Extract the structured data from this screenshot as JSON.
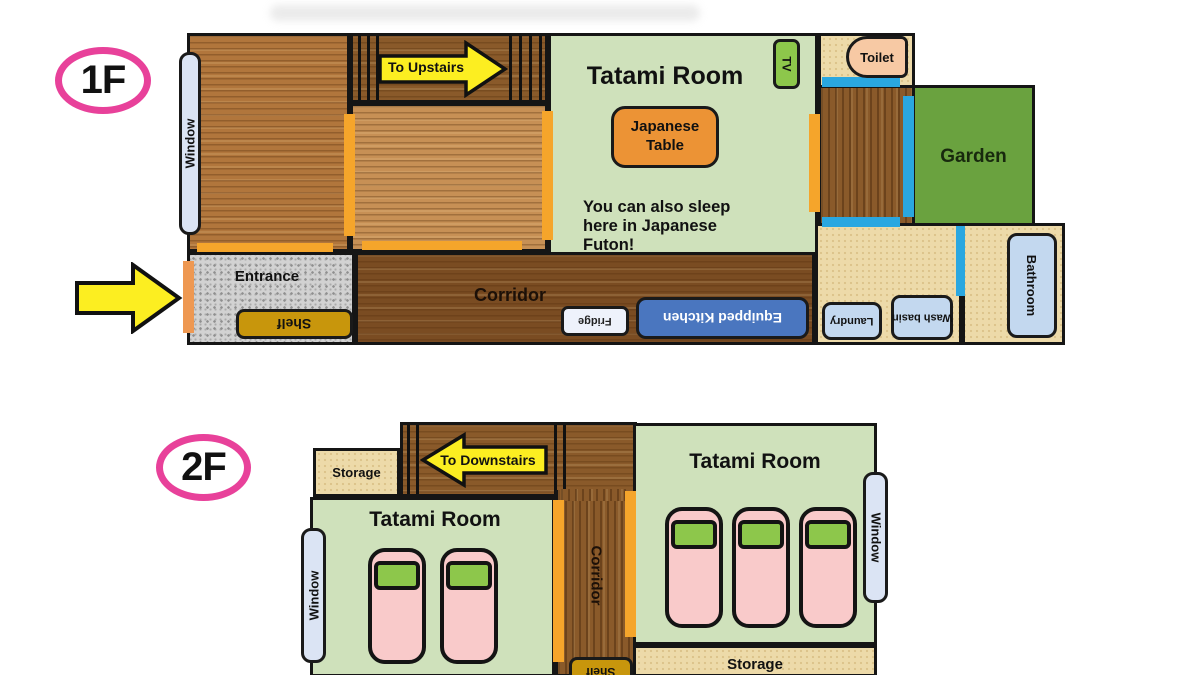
{
  "f1": {
    "badge": "1F",
    "window": "Window",
    "to_upstairs": "To Upstairs",
    "tatami_title": "Tatami Room",
    "tv": "TV",
    "japanese_table": "Japanese\nTable",
    "futon_note": "You can also sleep\nhere in Japanese\nFuton!",
    "toilet": "Toilet",
    "garden": "Garden",
    "entrance": "Entrance",
    "shelf": "Shelf",
    "corridor": "Corridor",
    "fridge": "Fridge",
    "kitchen": "Equipped Kitchen",
    "laundry": "Laundry",
    "wash_basin": "Wash\nbasin",
    "bathroom": "Bathroom"
  },
  "f2": {
    "badge": "2F",
    "storage_top": "Storage",
    "to_downstairs": "To Downstairs",
    "tatami_left": "Tatami Room",
    "tatami_right": "Tatami Room",
    "window_left": "Window",
    "window_right": "Window",
    "corridor": "Corridor",
    "shelf": "Shelf",
    "storage_bottom": "Storage"
  },
  "colors": {
    "badge_pink": "#e8419a",
    "arrow_yellow": "#fcee21",
    "tatami_green": "#cfe1bb",
    "garden_green": "#6aa23f",
    "door_orange": "#f5a52b",
    "entrance_door_orange": "#ee9852",
    "door_blue": "#2aa7e0",
    "kitchen_blue": "#4a76bf",
    "shelf_gold": "#c8960c",
    "bed_pink": "#f9caca",
    "pillow_green": "#8dc74b",
    "toilet_salmon": "#f7c9a4",
    "infobox_blue": "#c3d8ef"
  }
}
